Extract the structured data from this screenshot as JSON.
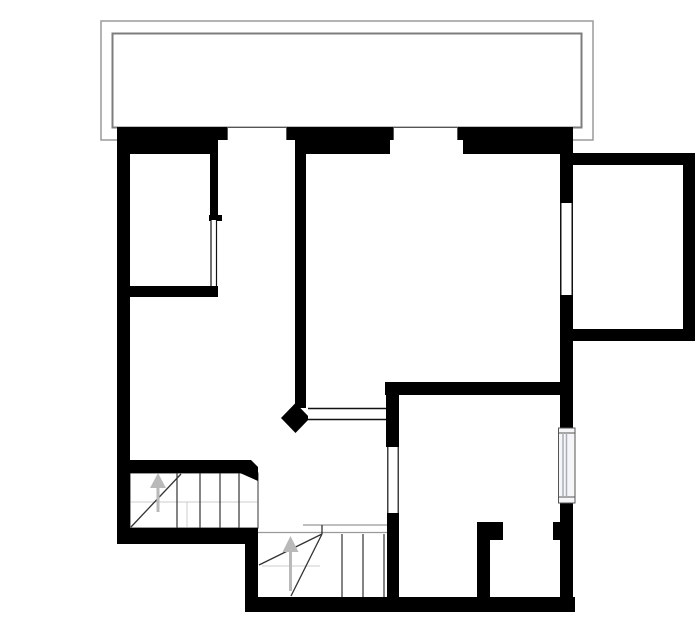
{
  "meta": {
    "canvas": {
      "width": 700,
      "height": 644
    },
    "drawing_type": "floor-plan"
  },
  "colors": {
    "background": "#ffffff",
    "wall": "#000000",
    "step_line": "#333333",
    "slit_line": "#111111",
    "balcony_outer": "#9a9a9a",
    "balcony_inner": "#7d7d7d",
    "landing_line": "#999999",
    "guide_line": "#cccccc",
    "arrow": "#b9b9b9",
    "window_frame": "#555555",
    "window_glaze": "#a9aeb8",
    "window_fill": "#f6f6f8",
    "white": "#ffffff"
  },
  "balcony": {
    "outer": {
      "x": 101,
      "y": 21,
      "w": 492,
      "h": 119
    },
    "inner": {
      "x": 112.5,
      "y": 33.5,
      "w": 469,
      "h": 94
    }
  },
  "walls": {
    "rects": [
      {
        "name": "top-exterior-wall",
        "x": 117,
        "y": 127,
        "w": 456,
        "h": 27
      },
      {
        "name": "left-exterior-wall",
        "x": 117,
        "y": 127,
        "w": 13,
        "h": 415
      },
      {
        "name": "right-exterior-wall-upper",
        "x": 560,
        "y": 127,
        "w": 13,
        "h": 76
      },
      {
        "name": "right-exterior-wall-middle",
        "x": 560,
        "y": 295,
        "w": 13,
        "h": 133
      },
      {
        "name": "right-exterior-wall-lower",
        "x": 560,
        "y": 503,
        "w": 13,
        "h": 109
      },
      {
        "name": "hall-bottom-exterior-wall",
        "x": 117,
        "y": 528,
        "w": 141,
        "h": 16
      },
      {
        "name": "step-transition-exterior-wall",
        "x": 245,
        "y": 528,
        "w": 13,
        "h": 84
      },
      {
        "name": "bottom-exterior-wall",
        "x": 245,
        "y": 597,
        "w": 330,
        "h": 15
      },
      {
        "name": "bedroom-partition-wall",
        "x": 210,
        "y": 152,
        "w": 8,
        "h": 66
      },
      {
        "name": "bedroom-partition-cap",
        "x": 209,
        "y": 215,
        "w": 13,
        "h": 6
      },
      {
        "name": "bedroom-bottom-wall",
        "x": 117,
        "y": 286,
        "w": 101,
        "h": 11
      },
      {
        "name": "central-partition-wall",
        "x": 295,
        "y": 138,
        "w": 11,
        "h": 270
      },
      {
        "name": "lower-room-top-wall",
        "x": 385,
        "y": 382,
        "w": 188,
        "h": 13
      },
      {
        "name": "lower-room-door-jamb-upper",
        "x": 386,
        "y": 382,
        "w": 13,
        "h": 65
      },
      {
        "name": "lower-room-door-jamb-lower",
        "x": 387,
        "y": 512,
        "w": 12,
        "h": 91
      },
      {
        "name": "closet-partition-wall",
        "x": 477,
        "y": 522,
        "w": 13,
        "h": 80
      },
      {
        "name": "closet-door-stub-left",
        "x": 490,
        "y": 522,
        "w": 13,
        "h": 18
      },
      {
        "name": "closet-door-stub-right",
        "x": 553,
        "y": 522,
        "w": 8,
        "h": 18
      },
      {
        "name": "stair-top-wall",
        "x": 117,
        "y": 460,
        "w": 123,
        "h": 13
      },
      {
        "name": "annex-top-wall",
        "x": 573,
        "y": 153,
        "w": 122,
        "h": 12
      },
      {
        "name": "annex-right-wall",
        "x": 683,
        "y": 153,
        "w": 12,
        "h": 188
      },
      {
        "name": "annex-bottom-wall",
        "x": 573,
        "y": 329,
        "w": 122,
        "h": 12
      }
    ],
    "polygons": [
      {
        "name": "stair-wall-angled-end",
        "points": "240,460 251,460 258,467 258,481 240,473"
      },
      {
        "name": "central-wall-end-diamond",
        "points": "295.5,403 310,418 295.5,433 281,418"
      }
    ]
  },
  "windows": {
    "top": [
      {
        "name": "top-window-left-outer",
        "x": 227.5,
        "y": 127.5,
        "w": 59,
        "h": 13,
        "stroke": true
      },
      {
        "name": "top-window-left-inner",
        "x": 218,
        "y": 140,
        "w": 77,
        "h": 14,
        "stroke": false
      },
      {
        "name": "top-window-right-outer",
        "x": 393.5,
        "y": 127.5,
        "w": 64,
        "h": 13,
        "stroke": true
      },
      {
        "name": "top-window-right-inner",
        "x": 390,
        "y": 140,
        "w": 73,
        "h": 14,
        "stroke": false
      }
    ],
    "right_upper": {
      "name": "right-wall-window-opening",
      "rect": {
        "x": 560,
        "y": 203,
        "w": 13,
        "h": 92
      },
      "lines_x": [
        560.75,
        572.25
      ],
      "y1": 203,
      "y2": 295
    },
    "right_lower": {
      "name": "lower-room-window",
      "rect": {
        "x": 558.5,
        "y": 428,
        "w": 16.5,
        "h": 75
      },
      "sill_y": [
        433,
        497
      ],
      "glaze_x": [
        563,
        566.5
      ]
    }
  },
  "doors": [
    {
      "name": "bedroom-door-opening",
      "rect": {
        "x": 210.5,
        "y": 220,
        "w": 6.5,
        "h": 66
      },
      "lines_x": [
        211,
        216.5
      ],
      "y1": 220,
      "y2": 286
    },
    {
      "name": "lower-room-door-opening",
      "rect": {
        "x": 387,
        "y": 447,
        "w": 12,
        "h": 66
      },
      "lines_x": [
        387.8,
        398.2
      ],
      "y1": 447,
      "y2": 513
    }
  ],
  "pass_through": {
    "name": "pass-through-opening",
    "rect": {
      "x": 308,
      "y": 409.5,
      "w": 78,
      "h": 9.5
    },
    "lines_y": [
      408.5,
      419.5
    ],
    "x1": 308,
    "x2": 386
  },
  "stairs": {
    "upper": {
      "name": "upper-stair-flight",
      "frame": {
        "x": 130,
        "y": 473,
        "w": 128,
        "h": 55
      },
      "step_lines_x": [
        177,
        200,
        220,
        239
      ],
      "steps_y1": 473,
      "steps_y2": 528,
      "diagonals": [
        {
          "x1": 131,
          "y1": 527,
          "x2": 181,
          "y2": 474
        }
      ],
      "guides": [
        {
          "x1": 131,
          "y1": 502,
          "x2": 257,
          "y2": 502
        },
        {
          "x1": 187,
          "y1": 502,
          "x2": 187,
          "y2": 527
        }
      ],
      "arrow": {
        "stem": {
          "x": 156.5,
          "y": 486,
          "w": 3,
          "h": 26
        },
        "head": "158,473 166,488 150,488"
      }
    },
    "lower": {
      "name": "lower-stair-flight",
      "landing_lines": [
        {
          "x1": 303,
          "y1": 525,
          "x2": 397,
          "y2": 525
        },
        {
          "x1": 258,
          "y1": 532.5,
          "x2": 397,
          "y2": 532.5
        }
      ],
      "step_lines_x": [
        342,
        363,
        384
      ],
      "steps_y1": 534,
      "steps_y2": 597,
      "diagonals": [
        {
          "x1": 322,
          "y1": 534,
          "x2": 259,
          "y2": 565
        },
        {
          "x1": 322,
          "y1": 534,
          "x2": 291,
          "y2": 596
        },
        {
          "x1": 322,
          "y1": 525,
          "x2": 322,
          "y2": 534
        }
      ],
      "guides": [
        {
          "x1": 262,
          "y1": 566,
          "x2": 320,
          "y2": 566
        }
      ],
      "arrow": {
        "stem": {
          "x": 289,
          "y": 551,
          "w": 3,
          "h": 40
        },
        "head": "290.5,536 298.5,552 282.5,552"
      }
    }
  }
}
